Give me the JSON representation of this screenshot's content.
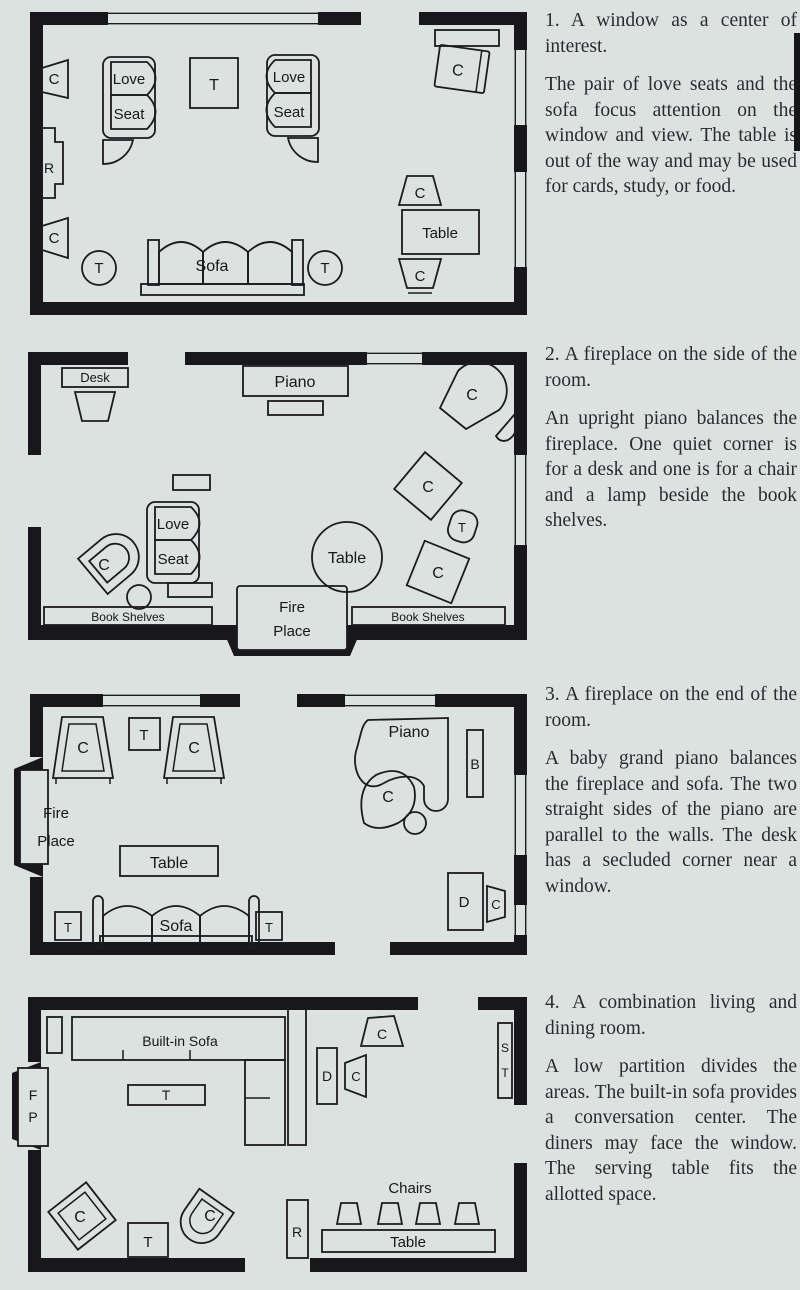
{
  "page": {
    "background": "#dce2df",
    "ink": "#17171c",
    "text_color": "#2b2a33"
  },
  "sections": [
    {
      "heading": "1. A window as a center of interest.",
      "body": "The pair of love seats and the sofa focus attention on the window and view. The table is out of the way and may be used for cards, study, or food."
    },
    {
      "heading": "2. A fireplace on the side of the room.",
      "body": "An upright piano balances the fireplace. One quiet corner is for a desk and one is for a chair and a lamp beside the book shelves."
    },
    {
      "heading": "3. A fireplace on the end of the room.",
      "body": "A baby grand piano balances the fireplace and sofa. The two straight sides of the piano are parallel to the walls. The desk has a secluded corner near a window."
    },
    {
      "heading": "4. A combination living and dining room.",
      "body": "A low partition divides the areas. The built-in sofa provides a conversation center. The diners may face the window. The serving table fits the allotted space."
    }
  ],
  "labels": {
    "chair": "C",
    "table_abbr": "T",
    "radio": "R",
    "bench": "B",
    "desk_abbr": "D",
    "serving_s": "S",
    "serving_t": "T",
    "fireplace_f": "F",
    "fireplace_p": "P",
    "love": "Love",
    "seat": "Seat",
    "sofa": "Sofa",
    "table": "Table",
    "desk": "Desk",
    "piano": "Piano",
    "fire": "Fire",
    "place": "Place",
    "book_shelves": "Book Shelves",
    "built_in_sofa": "Built-in Sofa",
    "chairs": "Chairs"
  }
}
